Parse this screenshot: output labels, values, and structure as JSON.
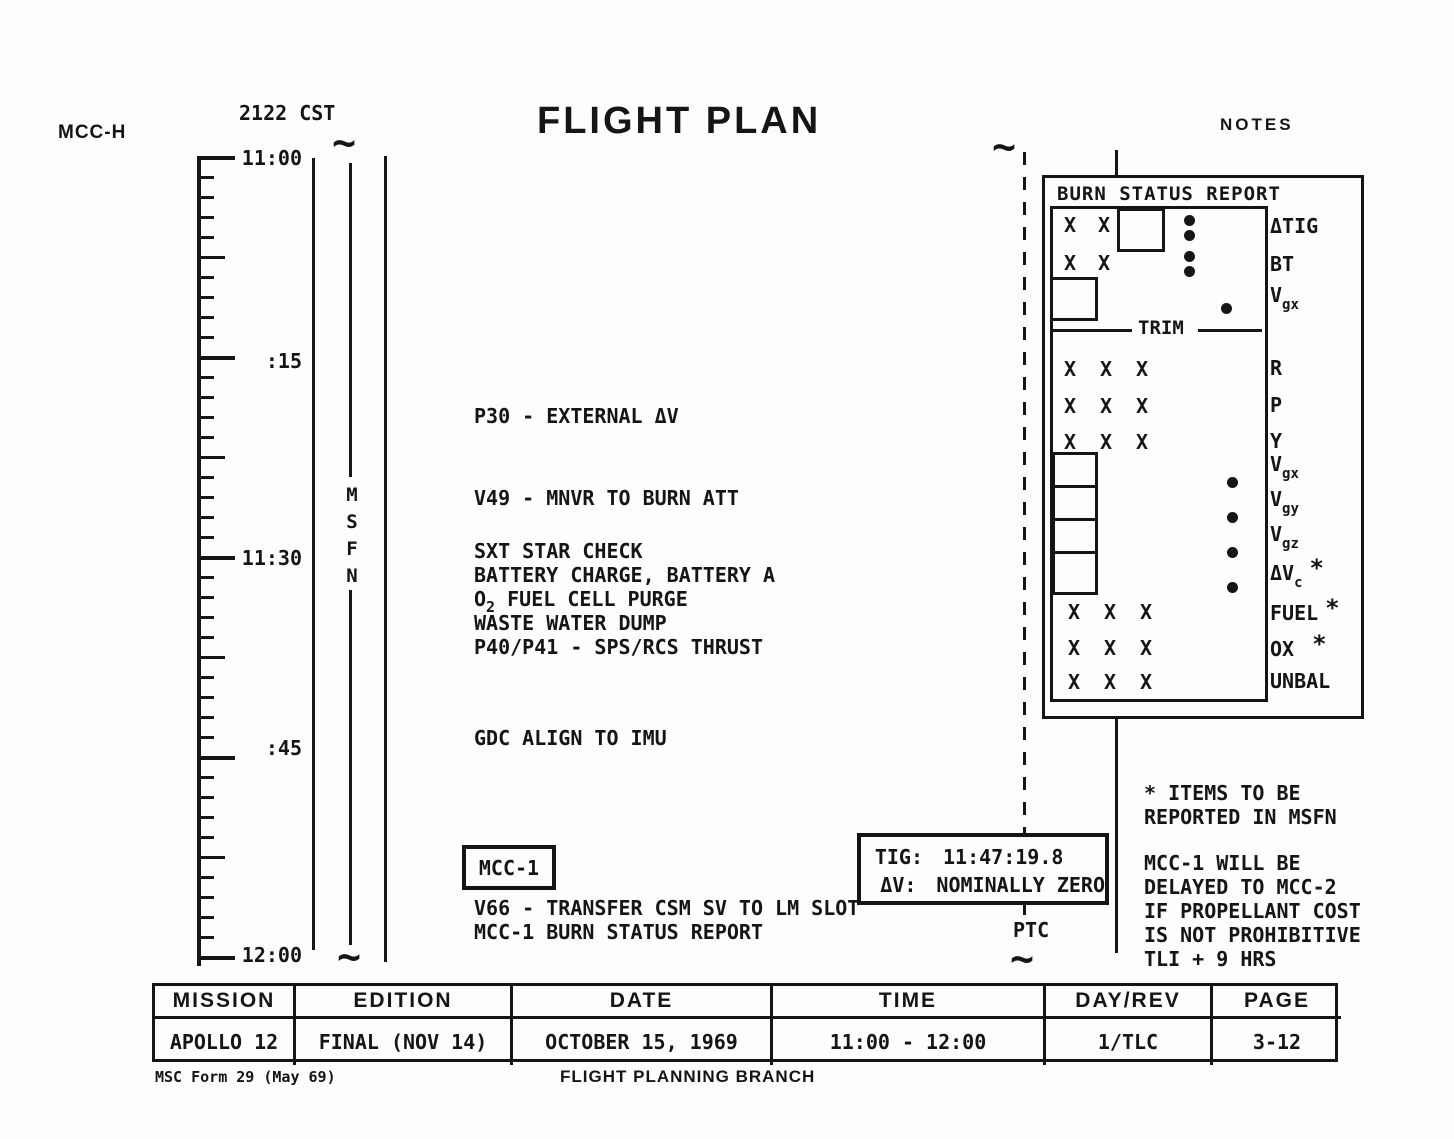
{
  "page": {
    "station_label": "MCC-H",
    "cst_time": "2122 CST",
    "title": "FLIGHT PLAN",
    "notes_label": "NOTES"
  },
  "timeline": {
    "labels": [
      "11:00",
      ":15",
      "11:30",
      ":45",
      "12:00"
    ],
    "network": "MSFN"
  },
  "activities": {
    "p30": "P30 - EXTERNAL ΔV",
    "v49": "V49 - MNVR TO BURN ATT",
    "sxt": "SXT STAR CHECK",
    "battery": "BATTERY CHARGE, BATTERY A",
    "o2_pre": "O",
    "o2_sub": "2",
    "o2_rest": " FUEL CELL PURGE",
    "waste": "WASTE WATER DUMP",
    "p40": "P40/P41 - SPS/RCS THRUST",
    "gdc": "GDC ALIGN TO IMU",
    "mcc1_flag": "MCC-1",
    "v66": "V66 - TRANSFER CSM SV TO LM SLOT",
    "mcc1_report": "MCC-1 BURN STATUS REPORT"
  },
  "burn_status": {
    "title": "BURN STATUS REPORT",
    "trim_label": "TRIM",
    "x_mark": "X",
    "rows": [
      {
        "main": "ΔTIG"
      },
      {
        "main": "BT"
      },
      {
        "main": "V",
        "sub": "gx"
      },
      {
        "main": "R"
      },
      {
        "main": "P"
      },
      {
        "main": "Y"
      },
      {
        "main": "V",
        "sub": "gx"
      },
      {
        "main": "V",
        "sub": "gy"
      },
      {
        "main": "V",
        "sub": "gz"
      },
      {
        "main": "ΔV",
        "sub": "c",
        "star": "*"
      },
      {
        "main": "FUEL",
        "star": "*"
      },
      {
        "main": "OX",
        "star": "*"
      },
      {
        "main": "UNBAL"
      }
    ]
  },
  "tig_box": {
    "tig_label": "TIG:",
    "tig_value": "11:47:19.8",
    "dv_label": "ΔV:",
    "dv_value": "NOMINALLY ZERO"
  },
  "ptc_label": "PTC",
  "notes": {
    "asterisk_note": [
      "* ITEMS TO BE",
      "REPORTED IN MSFN"
    ],
    "mcc_note": [
      "MCC-1 WILL BE",
      "DELAYED TO MCC-2",
      "IF PROPELLANT COST",
      "IS NOT PROHIBITIVE",
      "TLI + 9 HRS"
    ]
  },
  "footer_table": {
    "headers": [
      "MISSION",
      "EDITION",
      "DATE",
      "TIME",
      "DAY/REV",
      "PAGE"
    ],
    "values": [
      "APOLLO 12",
      "FINAL (NOV 14)",
      "OCTOBER 15, 1969",
      "11:00 - 12:00",
      "1/TLC",
      "3-12"
    ]
  },
  "footer": {
    "form_label": "MSC Form 29 (May 69)",
    "branch_label": "FLIGHT PLANNING BRANCH"
  }
}
